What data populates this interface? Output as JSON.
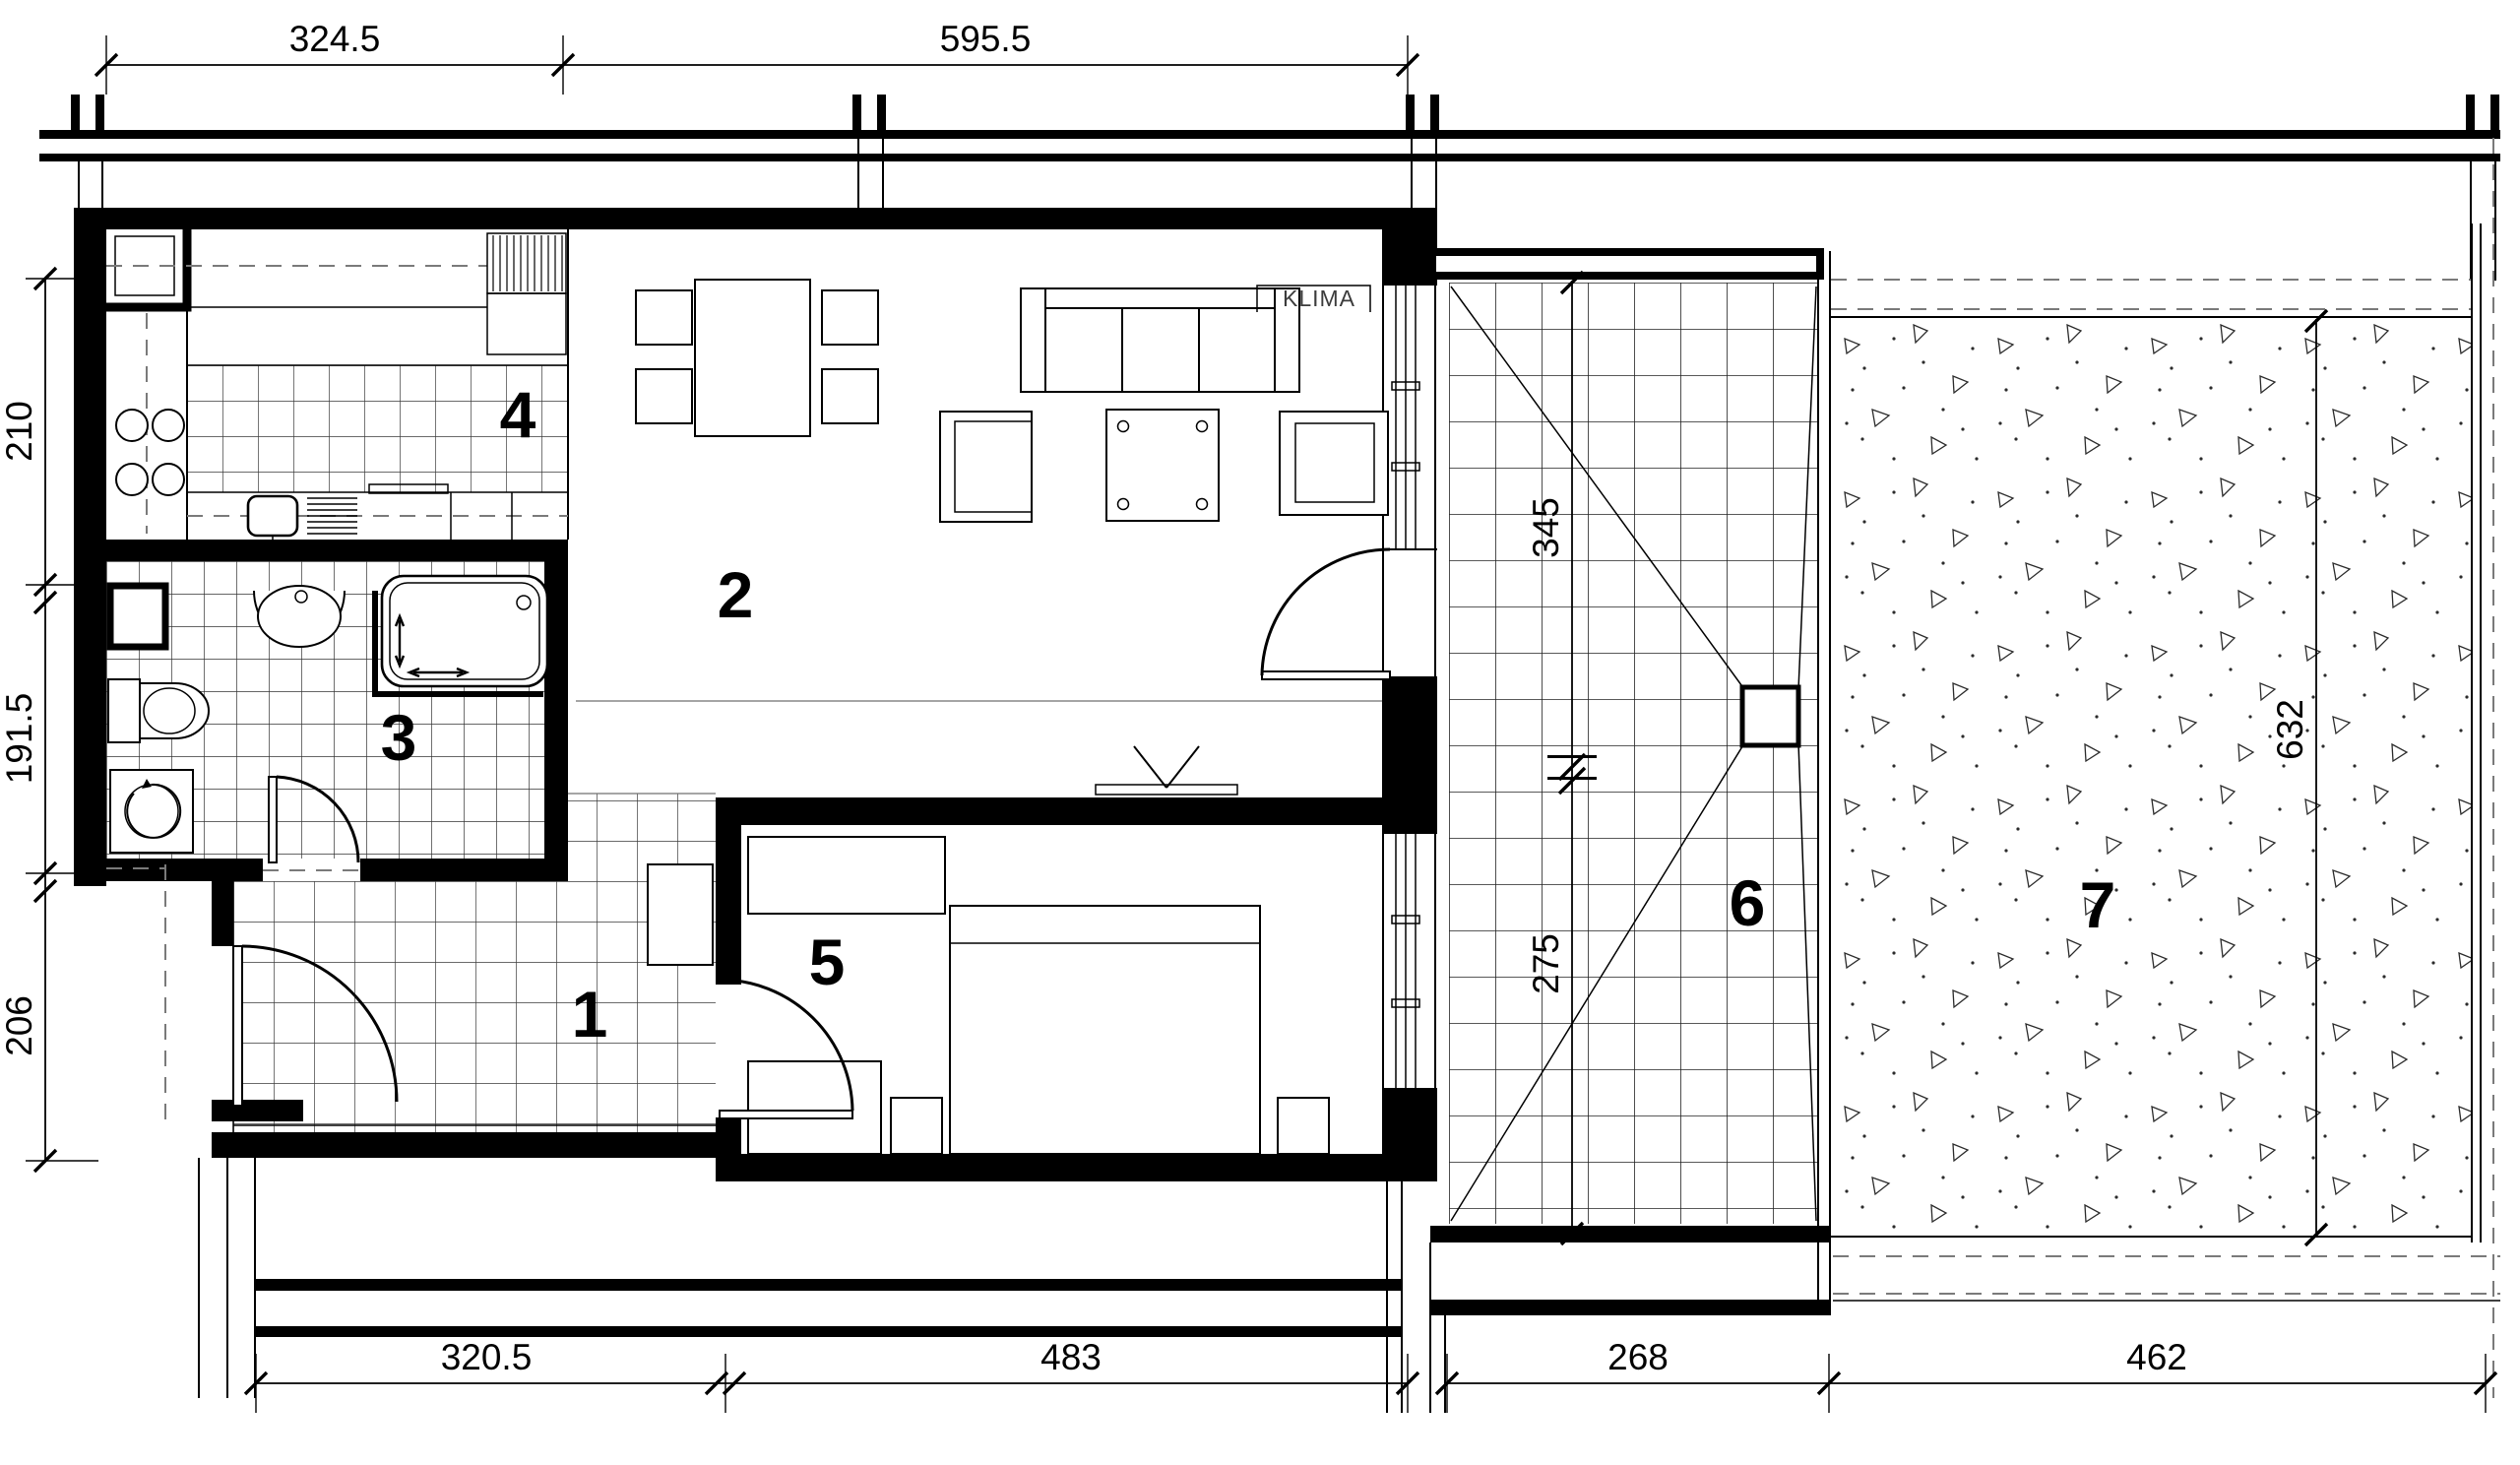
{
  "drawing": {
    "type": "apartment-floor-plan",
    "rooms": [
      {
        "number": "1"
      },
      {
        "number": "2"
      },
      {
        "number": "3"
      },
      {
        "number": "4"
      },
      {
        "number": "5"
      },
      {
        "number": "6"
      },
      {
        "number": "7"
      }
    ],
    "labels": {
      "klima": "KLIMA"
    },
    "dims": {
      "top": [
        "324.5",
        "595.5"
      ],
      "left": [
        "210",
        "191.5",
        "206"
      ],
      "bottom": [
        "320.5",
        "483",
        "268",
        "462"
      ],
      "balcony_vertical": [
        "345",
        "275"
      ],
      "terrace_vertical": [
        "632"
      ]
    },
    "colors": {
      "ink": "#000000",
      "paper": "#ffffff",
      "tile_line": "#3a3a3a"
    }
  }
}
